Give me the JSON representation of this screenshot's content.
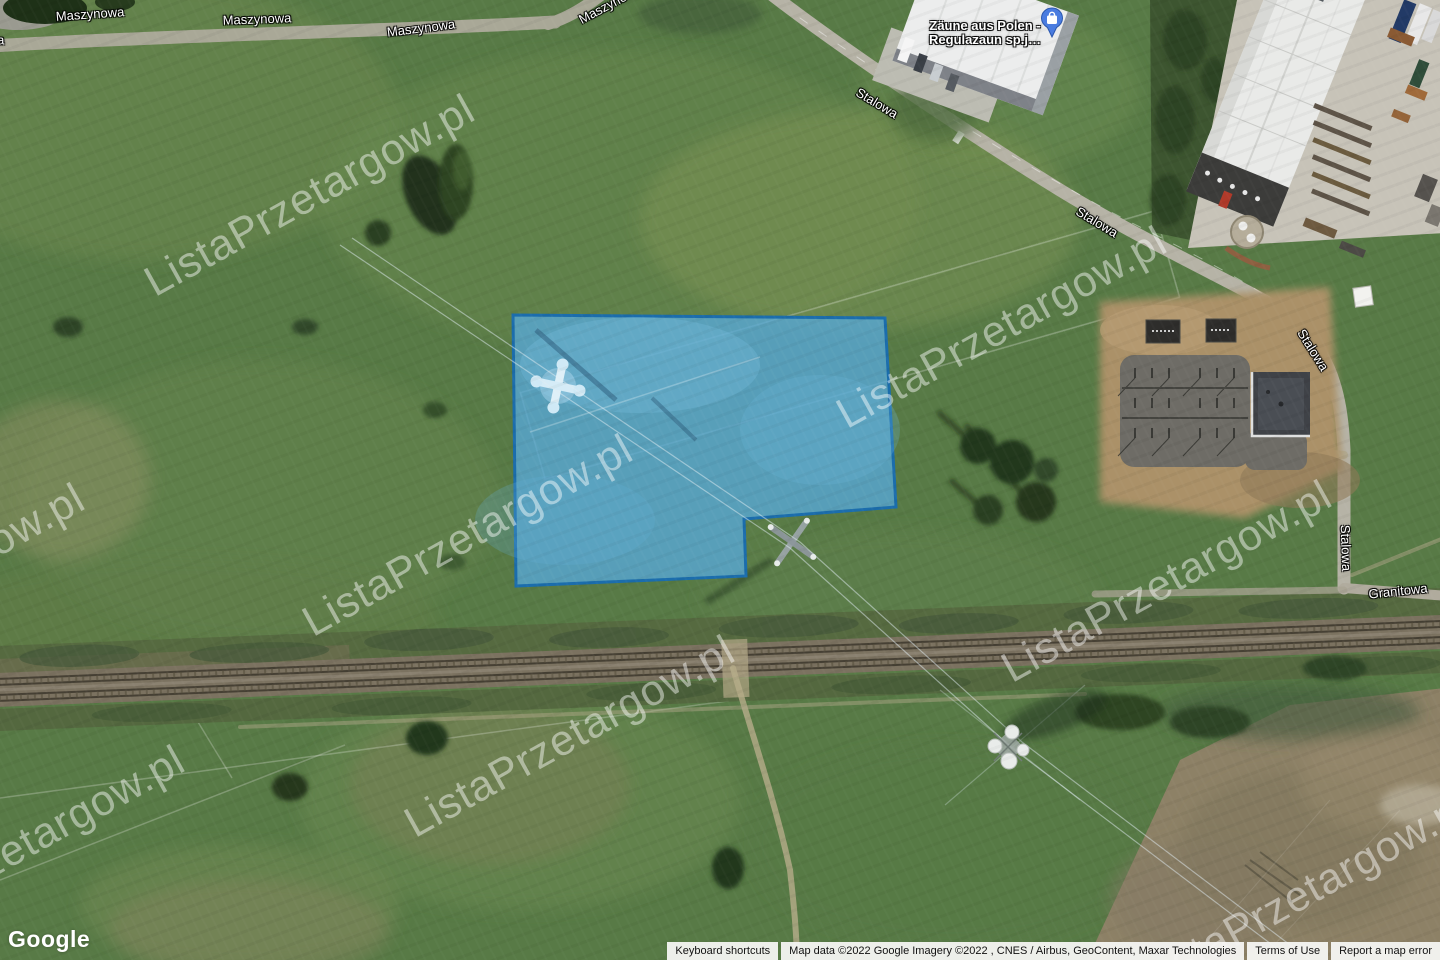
{
  "window": {
    "width": 1440,
    "height": 960,
    "view": "satellite"
  },
  "map": {
    "labels": {
      "maszynowa": "Maszynowa",
      "stalowa": "Stalowa",
      "granitowa": "Granitowa"
    },
    "poi": {
      "line1": "Zäune aus Polen -",
      "line2": "Regulazaun sp.j…",
      "marker_color": "#4a7ce0",
      "icon": "shopping-bag-icon"
    },
    "parcel": {
      "fill": "#57a8d6",
      "stroke": "#1b6dac"
    },
    "watermark": {
      "text": "ListaPrzetargow.pl",
      "color": "#ffffff"
    }
  },
  "branding": {
    "logo": "Google"
  },
  "attribution": {
    "keyboard_shortcuts": "Keyboard shortcuts",
    "map_data": "Map data ©2022 Google Imagery ©2022 , CNES / Airbus, GeoContent, Maxar Technologies",
    "terms_of_use": "Terms of Use",
    "report_error": "Report a map error"
  }
}
